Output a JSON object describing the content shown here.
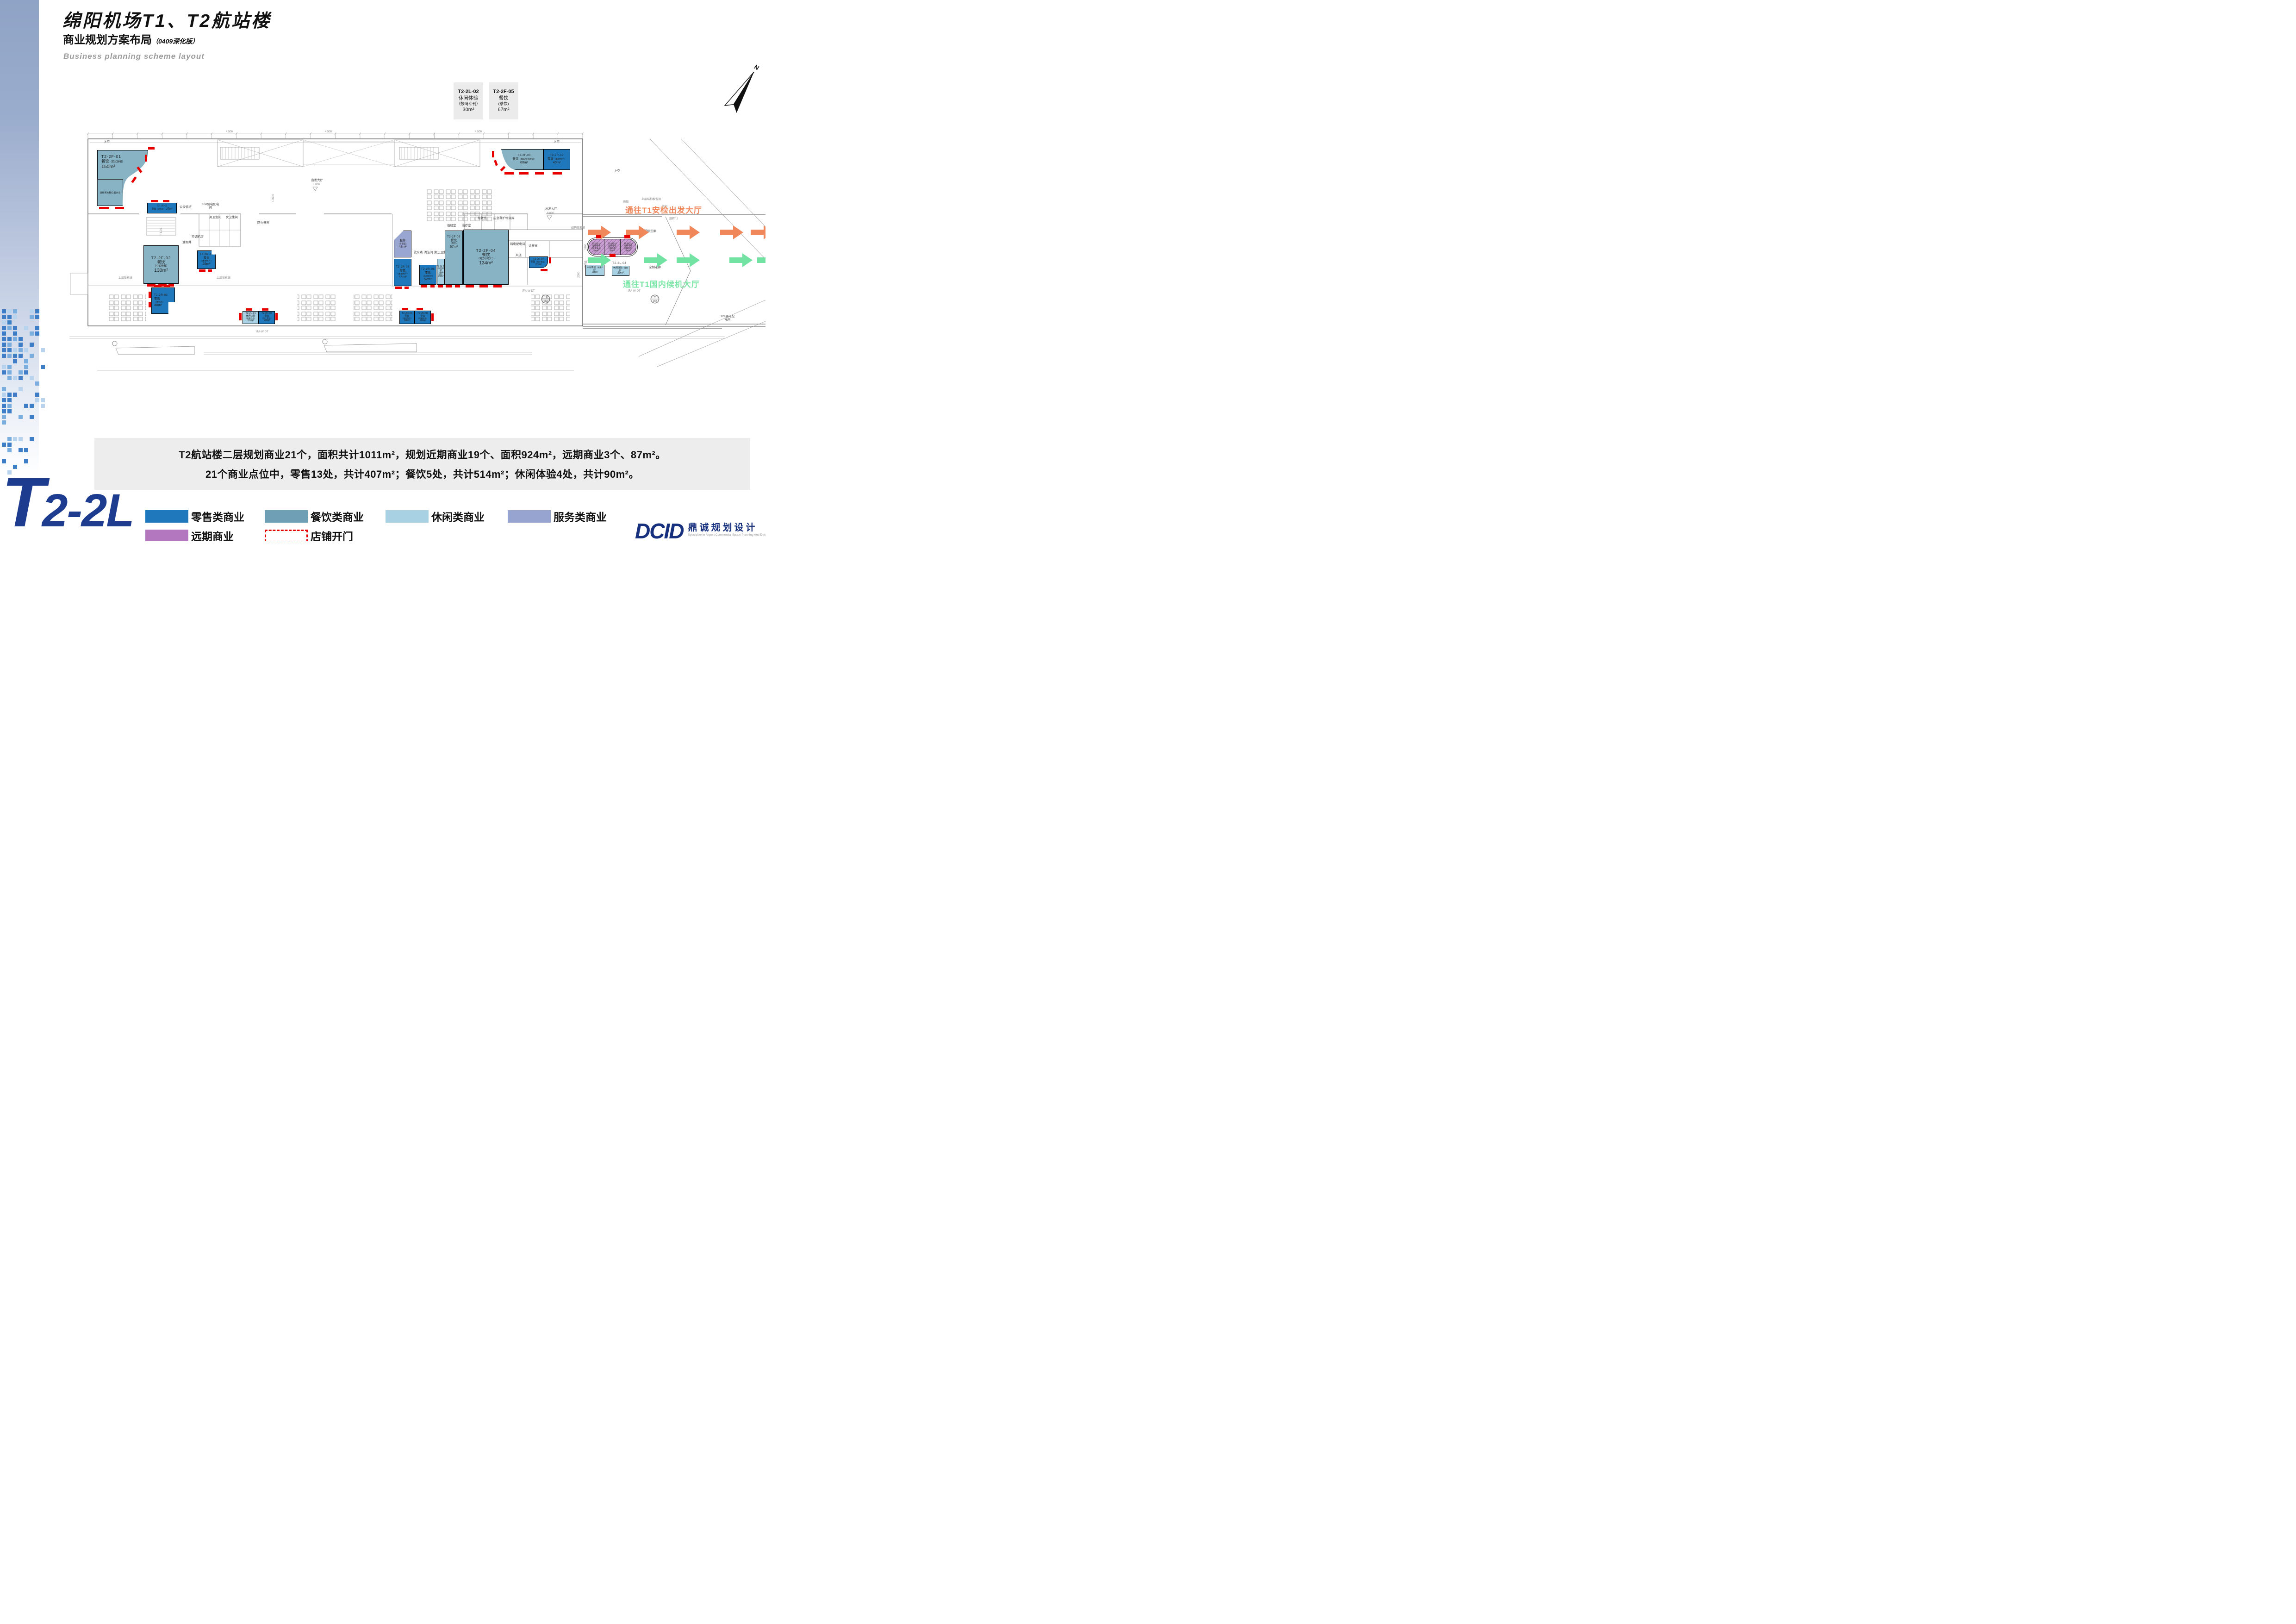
{
  "header": {
    "title": "绵阳机场T1、T2航站楼",
    "subtitle": "商业规划方案布局",
    "subtitle_note": "（0409深化版）",
    "subtitle_en": "Business planning scheme layout"
  },
  "compass": {
    "label": "N"
  },
  "callouts": [
    {
      "code": "T2-2L-02",
      "category": "休闲体验",
      "sub": "（数码专刊）",
      "area": "30m²"
    },
    {
      "code": "T2-2F-05",
      "category": "餐饮",
      "sub": "(茶饮)",
      "area": "67m²"
    }
  ],
  "corridor": {
    "to_security": "通往T1安检出发大厅",
    "to_waiting": "通往T1国内候机大厅",
    "landside": "陆侧走廊",
    "airside": "空侧走廊"
  },
  "shops": [
    {
      "code": "T2-2F-01",
      "category": "餐饮",
      "sub": "（西式快餐）",
      "area": "150m²",
      "note": "操作间大致位置示意"
    },
    {
      "code": "T2-2F-02",
      "category": "餐饮",
      "sub": "（中式快餐）",
      "area": "130m²"
    },
    {
      "code": "T2-2F-03",
      "category": "餐饮",
      "sub": "（咖啡/饮品烘焙）",
      "area": "60m²"
    },
    {
      "code": "T2-2F-04",
      "category": "餐饮",
      "sub": "（地方小吃汇）",
      "area": "134m²"
    },
    {
      "code": "T2-2F-05",
      "category": "餐饮",
      "sub": "（茶饮）",
      "area": "67m²"
    },
    {
      "code": "T2-2R-01",
      "category": "零售",
      "sub": "（便利店）",
      "area": "27m²"
    },
    {
      "code": "T2-2R-02",
      "category": "零售",
      "sub": "（本地特产）",
      "area": "40m²"
    },
    {
      "code": "T2-2R-03",
      "category": "零售",
      "sub": "（便利店）",
      "area": "48m²"
    },
    {
      "code": "T2-2R-04",
      "category": "零售",
      "sub": "（加工食品）",
      "area": "20m²"
    },
    {
      "code": "T2-2R-05",
      "category": "零售",
      "sub": "（本地特产）",
      "area": "44m²"
    },
    {
      "code": "T2-2R-06",
      "category": "零售",
      "sub": "（品牌茶叶）",
      "area": "52m²"
    },
    {
      "code": "T2-2R-07",
      "category": "零售",
      "sub": "（加工食品）",
      "area": "20m²"
    },
    {
      "code": "T2-2R-08",
      "category": "零售",
      "sub": "（旅行用品）",
      "area": "20m²"
    },
    {
      "code": "T2-2R-09",
      "category": "零售",
      "sub": "（儿童玩具）",
      "area": "20m²"
    },
    {
      "code": "T2-2R-10",
      "category": "零售",
      "sub": "（本地特产）",
      "area": "29m²"
    },
    {
      "code": "T2-2R-11",
      "category": "远期零售",
      "sub": "（加工食品）",
      "area": "29m²"
    },
    {
      "code": "T2-2R-12",
      "category": "远期零售",
      "sub": "（便利店）",
      "area": "29m²"
    },
    {
      "code": "T2-2R-13",
      "category": "远期零售",
      "sub": "（便利店）",
      "area": "29m²"
    },
    {
      "code": "T2-2L-01",
      "category": "休闲体验",
      "sub": "（按摩产品）",
      "area": "20m²"
    },
    {
      "code": "T2-2L-02",
      "category": "休闲体验",
      "sub": "（数码书刊）",
      "area": "30m²"
    },
    {
      "code": "T2-2L-03",
      "category": "休闲体验",
      "sub": "（按摩产品）",
      "area": "20m²"
    },
    {
      "code": "T2-2L-04",
      "category": "休闲体验",
      "sub": "（睡眠舱）",
      "area": "20m²"
    },
    {
      "code": "",
      "category": "服务",
      "sub": "（母婴室）",
      "area": "48m²"
    }
  ],
  "plan_labels": [
    "上空",
    "上空",
    "上空",
    "出发大厅",
    "6.000",
    "出发大厅",
    "6.000",
    "陆侧走廊",
    "空侧走廊",
    "公安值班",
    "10#强电配电间",
    "空调机房",
    "男卫生间",
    "女卫生间",
    "抢救室",
    "应急救护物资库",
    "值班室",
    "治疗室",
    "诊断室",
    "弱电配电间",
    "风道",
    "饮水点",
    "清洁间",
    "第三卫生间",
    "油烟井",
    "上层投影线",
    "上层投影线",
    "防火卷帘",
    "结构变形缝",
    "上层结构板留洞",
    "余同",
    "旋转门",
    "雨棚",
    "12#强电配电间",
    "4,500",
    "4,500",
    "4,500",
    "17600",
    "13258",
    "3800",
    "2000",
    "详A-W-DT",
    "详A-W-DT",
    "详A-W-DT",
    "17\n002",
    "73\n002",
    "FT-05"
  ],
  "summary": {
    "line1": "T2航站楼二层规划商业21个，面积共计1011m²，规划近期商业19个、面积924m²，远期商业3个、87m²。",
    "line2": "21个商业点位中，零售13处，共计407m²；餐饮5处，共计514m²；休闲体验4处，共计90m²。"
  },
  "legend": {
    "items": [
      {
        "label": "零售类商业",
        "color": "#1f78bc"
      },
      {
        "label": "餐饮类商业",
        "color": "#6f9fb4"
      },
      {
        "label": "休闲类商业",
        "color": "#a8d2e4"
      },
      {
        "label": "服务类商业",
        "color": "#98a4d0"
      },
      {
        "label": "远期商业",
        "color": "#b277be"
      },
      {
        "label": "店铺开门",
        "color": "#e60000"
      }
    ]
  },
  "logo": {
    "page_code_t": "T",
    "page_code_rest": "2-2L",
    "brand": "DCID",
    "brand_cn": "鼎诚规划设计",
    "brand_en": "Specialize In Airport Commercial Space Planning And Designing"
  }
}
